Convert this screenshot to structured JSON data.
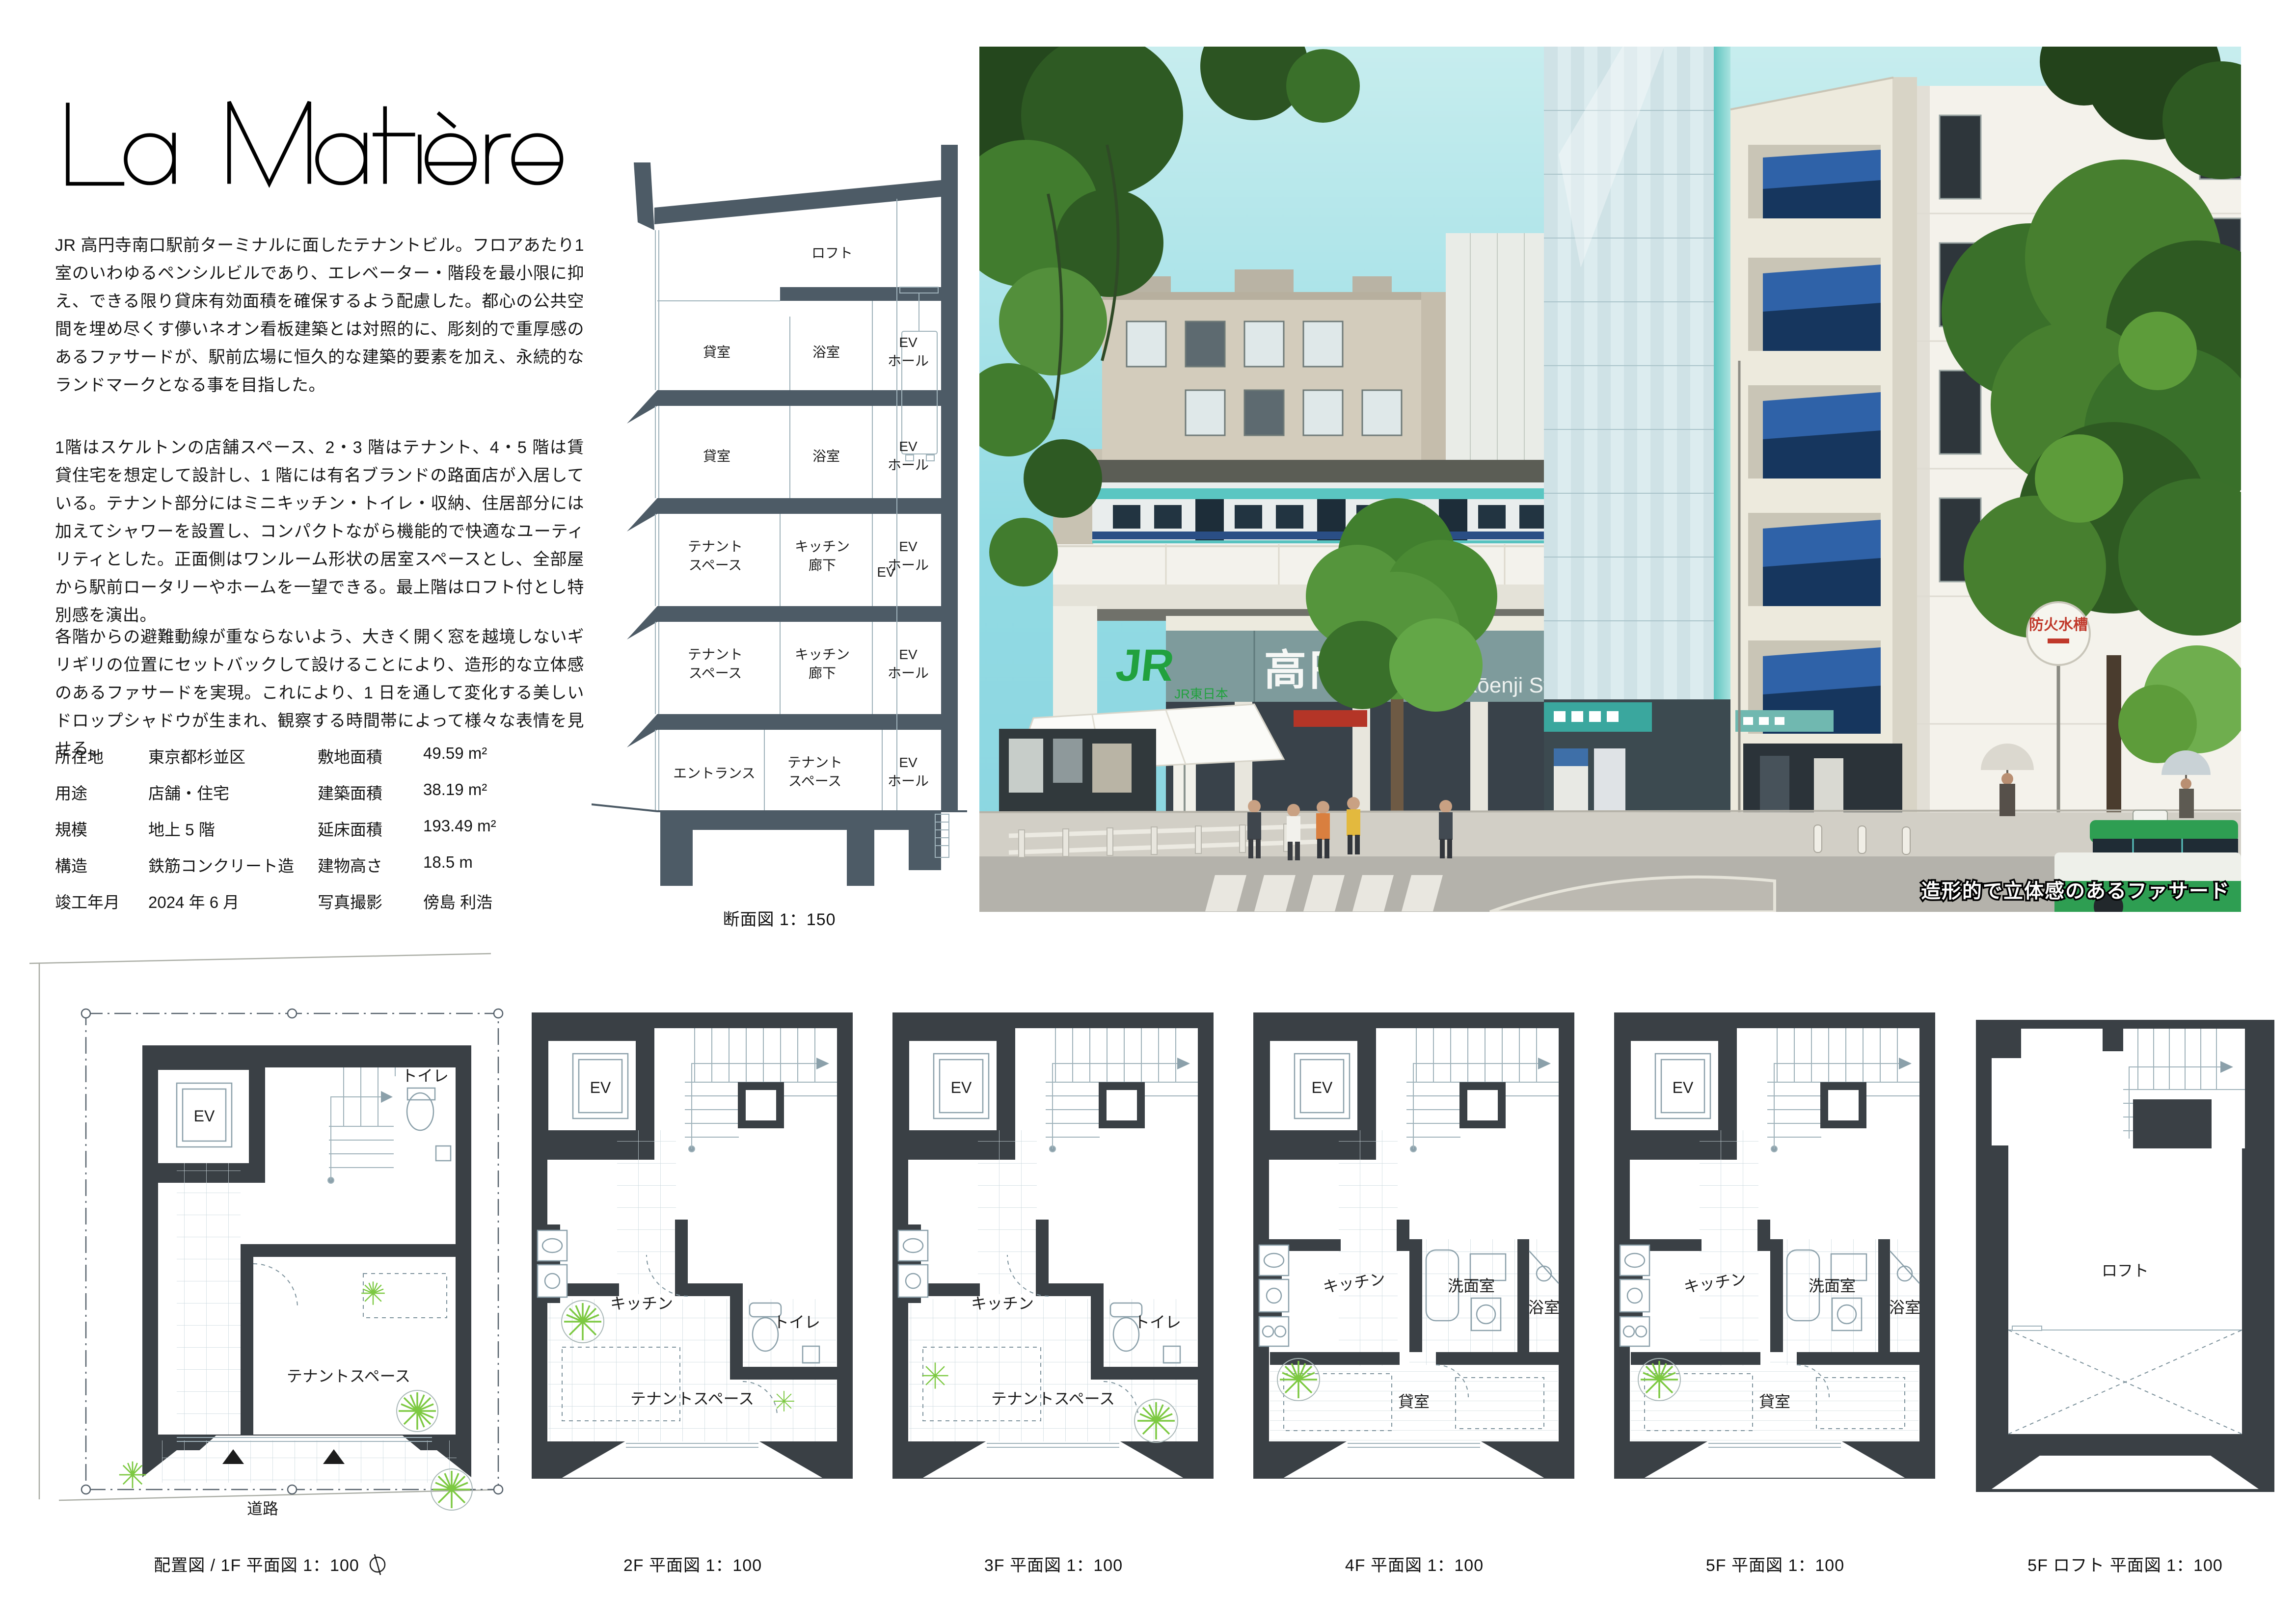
{
  "board": {
    "title": "La Matière"
  },
  "intro": {
    "paragraphs": [
      "JR 高円寺南口駅前ターミナルに面したテナントビル。フロアあたり1室のいわゆるペンシルビルであり、エレベーター・階段を最小限に抑え、できる限り貸床有効面積を確保するよう配慮した。都心の公共空間を埋め尽くす儚いネオン看板建築とは対照的に、彫刻的で重厚感のあるファサードが、駅前広場に恒久的な建築的要素を加え、永続的なランドマークとなる事を目指した。",
      "1階はスケルトンの店舗スペース、2・3 階はテナント、4・5 階は賃貸住宅を想定して設計し、1 階には有名ブランドの路面店が入居している。テナント部分にはミニキッチン・トイレ・収納、住居部分には加えてシャワーを設置し、コンパクトながら機能的で快適なユーティリティとした。正面側はワンルーム形状の居室スペースとし、全部屋から駅前ロータリーやホームを一望できる。最上階はロフト付とし特別感を演出。",
      "各階からの避難動線が重ならないよう、大きく開く窓を越境しないギリギリの位置にセットバックして設けることにより、造形的な立体感のあるファサードを実現。これにより、1 日を通して変化する美しいドロップシャドウが生まれ、観察する時間帯によって様々な表情を見せる。"
    ]
  },
  "specs": {
    "rows": [
      {
        "l1": "所在地",
        "v1": "東京都杉並区",
        "l2": "敷地面積",
        "v2": "49.59 m²"
      },
      {
        "l1": "用途",
        "v1": "店舗・住宅",
        "l2": "建築面積",
        "v2": "38.19 m²"
      },
      {
        "l1": "規模",
        "v1": "地上 5 階",
        "l2": "延床面積",
        "v2": "193.49 m²"
      },
      {
        "l1": "構造",
        "v1": "鉄筋コンクリート造",
        "l2": "建物高さ",
        "v2": "18.5 m"
      },
      {
        "l1": "竣工年月",
        "v1": "2024 年 6 月",
        "l2": "写真撮影",
        "v2": "傍島 利浩"
      }
    ]
  },
  "section": {
    "caption": "断面図  1：150",
    "loft": "ロフト",
    "kashitsu": "貸室",
    "yokushitsu": "浴室",
    "ev": "EV",
    "ev_hall": [
      "EV",
      "ホール"
    ],
    "tenant": [
      "テナント",
      "スペース"
    ],
    "kitchen": [
      "キッチン",
      "廊下"
    ],
    "entrance": "エントランス"
  },
  "photo": {
    "caption": "造形的で立体感のあるファサード",
    "sign_jr": "JR",
    "sign_jr_company": "JR東日本",
    "sign_station": "高円寺駅",
    "sign_station_en": "Kōenji Station",
    "sign_fire": "防火水槽"
  },
  "plans": {
    "captions": [
      "配置図 / 1F 平面図  1：100",
      "2F 平面図  1：100",
      "3F 平面図  1：100",
      "4F 平面図  1：100",
      "5F 平面図  1：100",
      "5F ロフト 平面図  1：100"
    ],
    "labels": {
      "ev": "EV",
      "toilet": "トイレ",
      "tenant": "テナントスペース",
      "kitchen": "キッチン",
      "washroom": "洗面室",
      "bath": "浴室",
      "room": "貸室",
      "loft": "ロフト",
      "road": "道路"
    }
  }
}
